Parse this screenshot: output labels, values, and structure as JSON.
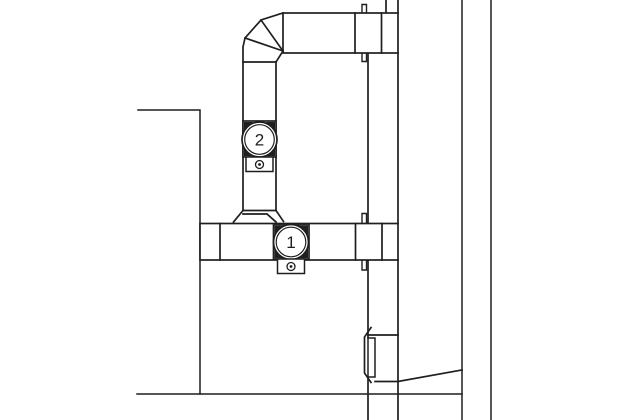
{
  "diagram": {
    "title": "duct-elevation-drawing",
    "background": "#ffffff",
    "line_color": "#1f1f1f",
    "callouts": {
      "device_1": "1",
      "device_2": "2"
    }
  }
}
